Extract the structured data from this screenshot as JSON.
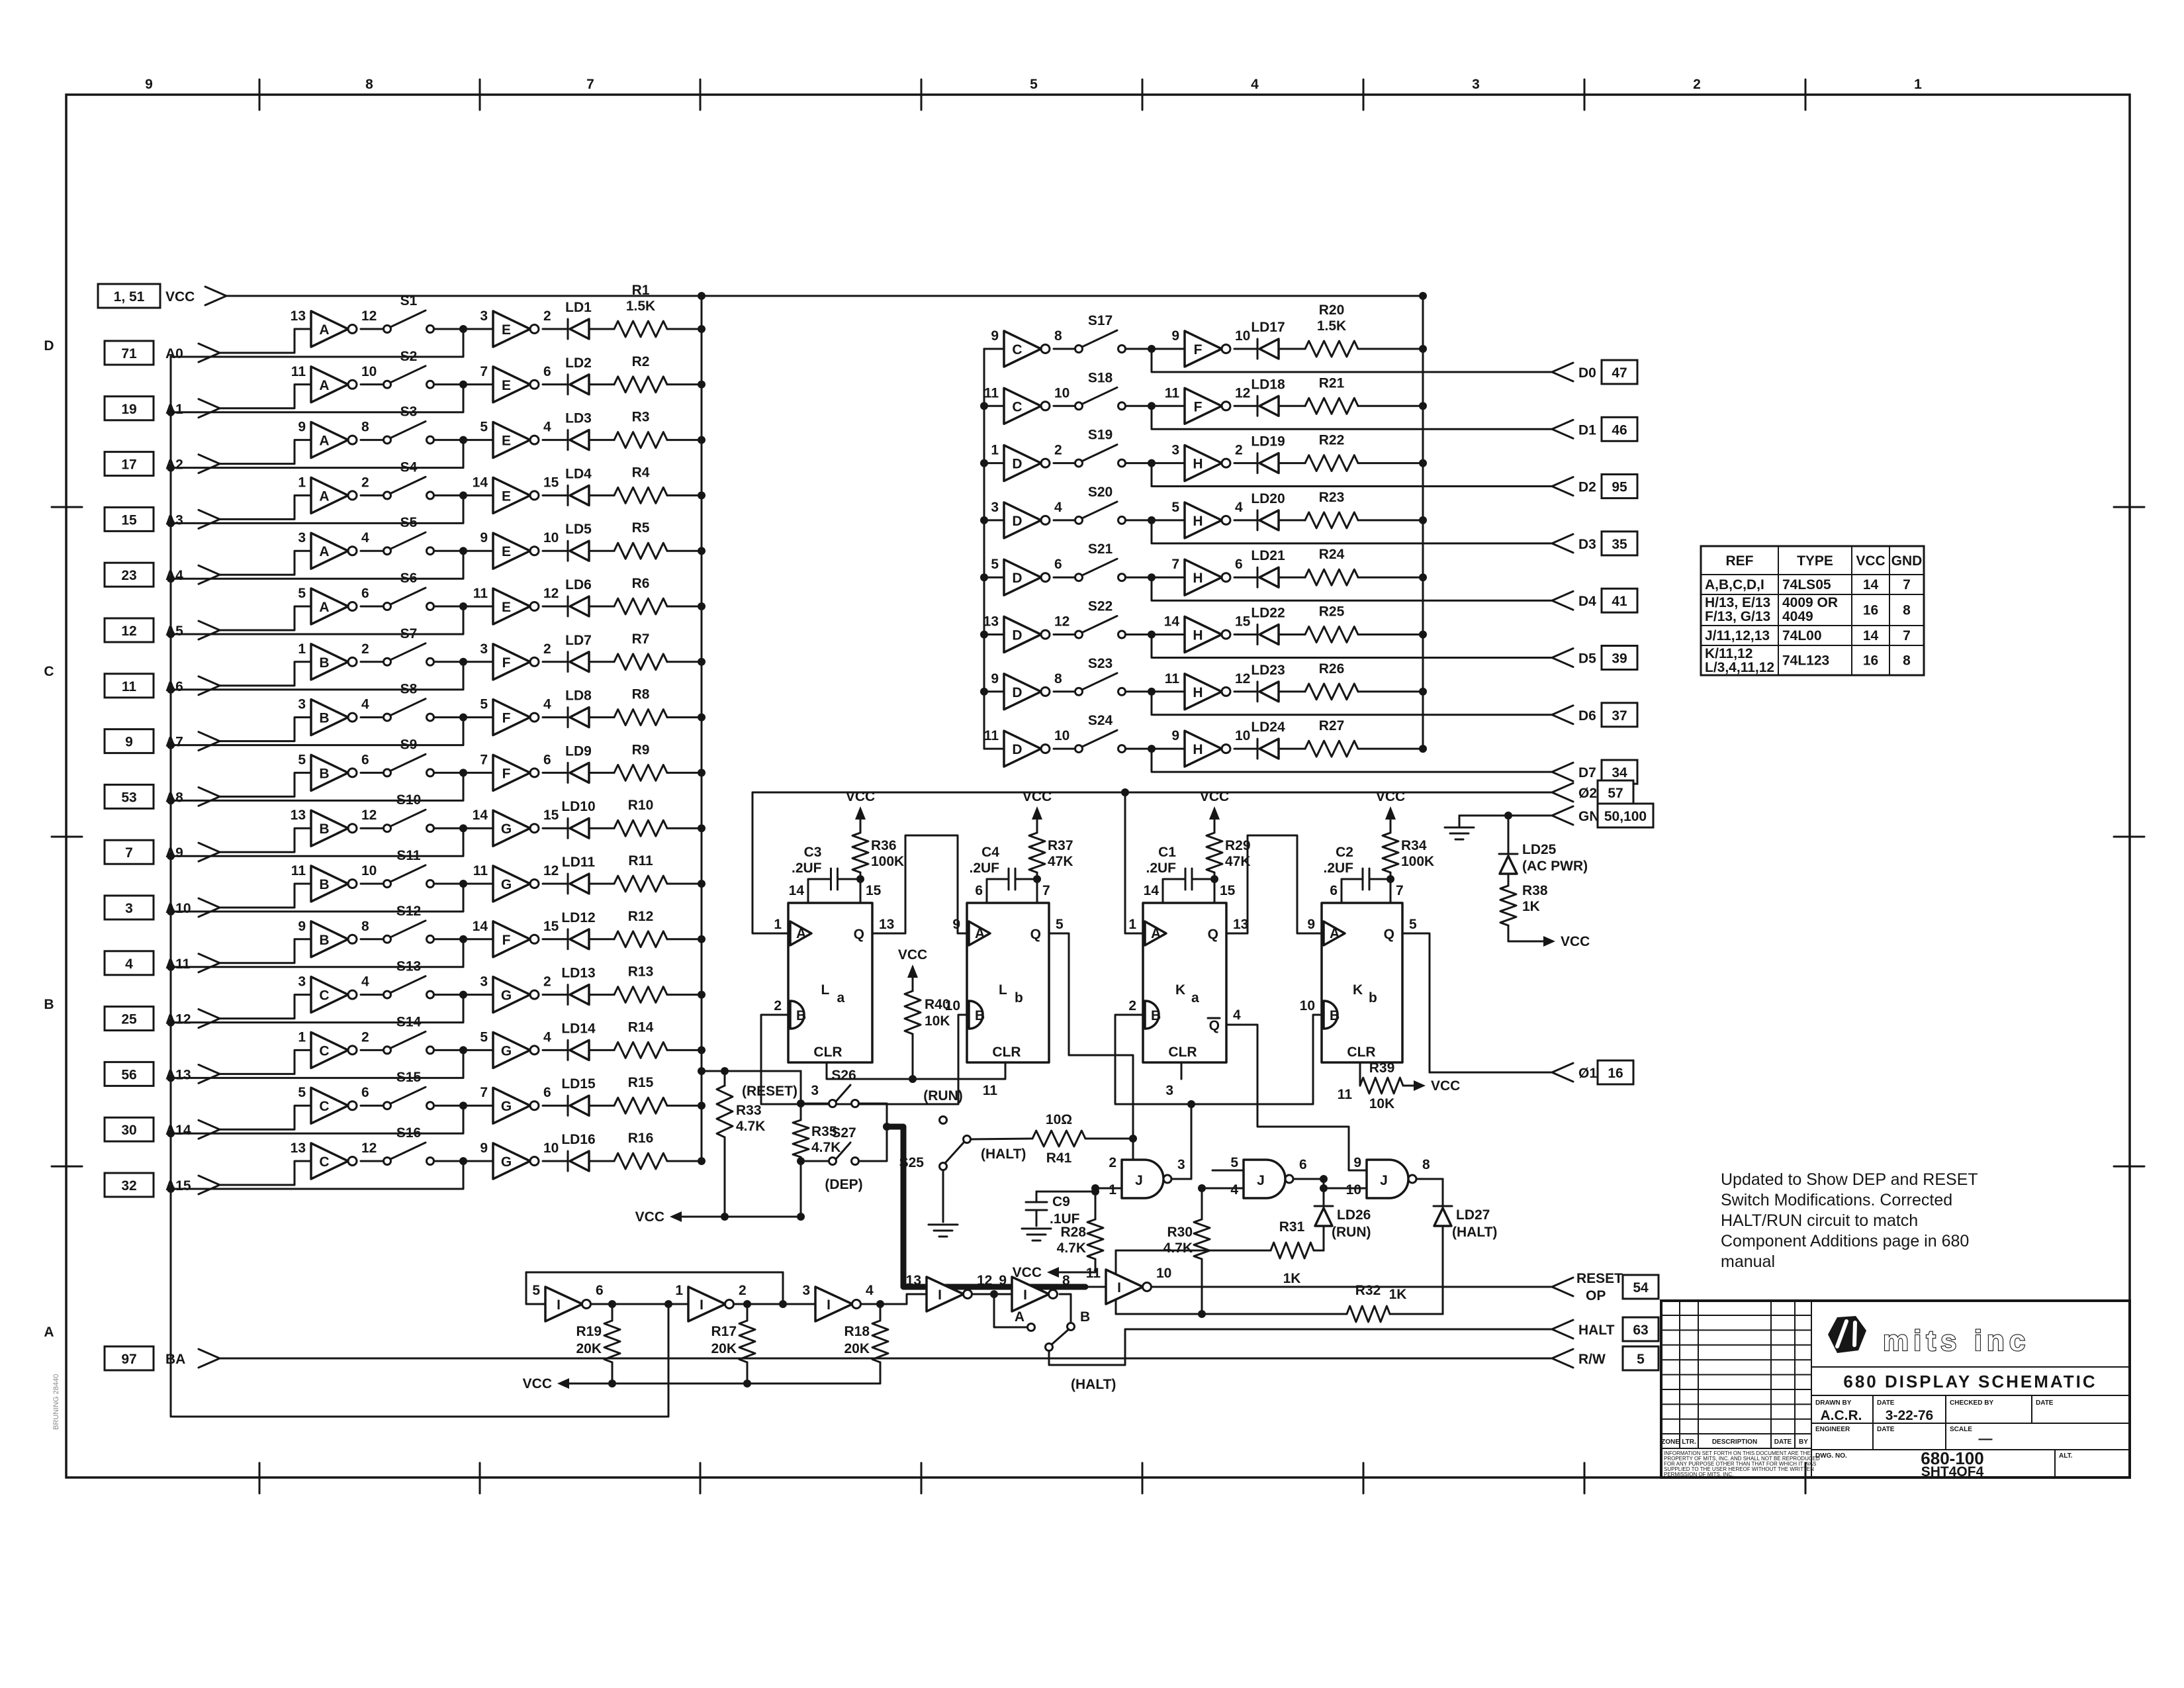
{
  "sheet": {
    "top_numbers": [
      "9",
      "8",
      "7",
      "5",
      "4",
      "3",
      "2",
      "1"
    ],
    "side_letters": [
      "D",
      "C",
      "B",
      "A"
    ],
    "stamp": "BRUNING 28440"
  },
  "left_inputs": [
    {
      "pin": "1, 51",
      "label": "VCC"
    },
    {
      "pin": "71",
      "label": "A0"
    },
    {
      "pin": "19",
      "label": "A1"
    },
    {
      "pin": "17",
      "label": "A2"
    },
    {
      "pin": "15",
      "label": "A3"
    },
    {
      "pin": "23",
      "label": "A4"
    },
    {
      "pin": "12",
      "label": "A5"
    },
    {
      "pin": "11",
      "label": "A6"
    },
    {
      "pin": "9",
      "label": "A7"
    },
    {
      "pin": "53",
      "label": "A8"
    },
    {
      "pin": "7",
      "label": "A9"
    },
    {
      "pin": "3",
      "label": "A10"
    },
    {
      "pin": "4",
      "label": "A11"
    },
    {
      "pin": "25",
      "label": "A12"
    },
    {
      "pin": "56",
      "label": "A13"
    },
    {
      "pin": "30",
      "label": "A14"
    },
    {
      "pin": "32",
      "label": "A15"
    },
    {
      "pin": "97",
      "label": "BA"
    }
  ],
  "left_rows": [
    {
      "p1": "13",
      "b1": "A",
      "p2": "12",
      "sw": "S1",
      "p3": "3",
      "b2": "E",
      "p4": "2",
      "led": "LD1",
      "res": "R1",
      "val": "1.5K"
    },
    {
      "p1": "11",
      "b1": "A",
      "p2": "10",
      "sw": "S2",
      "p3": "7",
      "b2": "E",
      "p4": "6",
      "led": "LD2",
      "res": "R2"
    },
    {
      "p1": "9",
      "b1": "A",
      "p2": "8",
      "sw": "S3",
      "p3": "5",
      "b2": "E",
      "p4": "4",
      "led": "LD3",
      "res": "R3"
    },
    {
      "p1": "1",
      "b1": "A",
      "p2": "2",
      "sw": "S4",
      "p3": "14",
      "b2": "E",
      "p4": "15",
      "led": "LD4",
      "res": "R4"
    },
    {
      "p1": "3",
      "b1": "A",
      "p2": "4",
      "sw": "S5",
      "p3": "9",
      "b2": "E",
      "p4": "10",
      "led": "LD5",
      "res": "R5"
    },
    {
      "p1": "5",
      "b1": "A",
      "p2": "6",
      "sw": "S6",
      "p3": "11",
      "b2": "E",
      "p4": "12",
      "led": "LD6",
      "res": "R6"
    },
    {
      "p1": "1",
      "b1": "B",
      "p2": "2",
      "sw": "S7",
      "p3": "3",
      "b2": "F",
      "p4": "2",
      "led": "LD7",
      "res": "R7"
    },
    {
      "p1": "3",
      "b1": "B",
      "p2": "4",
      "sw": "S8",
      "p3": "5",
      "b2": "F",
      "p4": "4",
      "led": "LD8",
      "res": "R8"
    },
    {
      "p1": "5",
      "b1": "B",
      "p2": "6",
      "sw": "S9",
      "p3": "7",
      "b2": "F",
      "p4": "6",
      "led": "LD9",
      "res": "R9"
    },
    {
      "p1": "13",
      "b1": "B",
      "p2": "12",
      "sw": "S10",
      "p3": "14",
      "b2": "G",
      "p4": "15",
      "led": "LD10",
      "res": "R10"
    },
    {
      "p1": "11",
      "b1": "B",
      "p2": "10",
      "sw": "S11",
      "p3": "11",
      "b2": "G",
      "p4": "12",
      "led": "LD11",
      "res": "R11"
    },
    {
      "p1": "9",
      "b1": "B",
      "p2": "8",
      "sw": "S12",
      "p3": "14",
      "b2": "F",
      "p4": "15",
      "led": "LD12",
      "res": "R12"
    },
    {
      "p1": "3",
      "b1": "C",
      "p2": "4",
      "sw": "S13",
      "p3": "3",
      "b2": "G",
      "p4": "2",
      "led": "LD13",
      "res": "R13"
    },
    {
      "p1": "1",
      "b1": "C",
      "p2": "2",
      "sw": "S14",
      "p3": "5",
      "b2": "G",
      "p4": "4",
      "led": "LD14",
      "res": "R14"
    },
    {
      "p1": "5",
      "b1": "C",
      "p2": "6",
      "sw": "S15",
      "p3": "7",
      "b2": "G",
      "p4": "6",
      "led": "LD15",
      "res": "R15"
    },
    {
      "p1": "13",
      "b1": "C",
      "p2": "12",
      "sw": "S16",
      "p3": "9",
      "b2": "G",
      "p4": "10",
      "led": "LD16",
      "res": "R16"
    }
  ],
  "right_rows": [
    {
      "p1": "9",
      "b1": "C",
      "p2": "8",
      "sw": "S17",
      "p3": "9",
      "b2": "F",
      "p4": "10",
      "led": "LD17",
      "res": "R20",
      "val": "1.5K",
      "out": "D0",
      "outpin": "47"
    },
    {
      "p1": "11",
      "b1": "C",
      "p2": "10",
      "sw": "S18",
      "p3": "11",
      "b2": "F",
      "p4": "12",
      "led": "LD18",
      "res": "R21",
      "out": "D1",
      "outpin": "46"
    },
    {
      "p1": "1",
      "b1": "D",
      "p2": "2",
      "sw": "S19",
      "p3": "3",
      "b2": "H",
      "p4": "2",
      "led": "LD19",
      "res": "R22",
      "out": "D2",
      "outpin": "95"
    },
    {
      "p1": "3",
      "b1": "D",
      "p2": "4",
      "sw": "S20",
      "p3": "5",
      "b2": "H",
      "p4": "4",
      "led": "LD20",
      "res": "R23",
      "out": "D3",
      "outpin": "35"
    },
    {
      "p1": "5",
      "b1": "D",
      "p2": "6",
      "sw": "S21",
      "p3": "7",
      "b2": "H",
      "p4": "6",
      "led": "LD21",
      "res": "R24",
      "out": "D4",
      "outpin": "41"
    },
    {
      "p1": "13",
      "b1": "D",
      "p2": "12",
      "sw": "S22",
      "p3": "14",
      "b2": "H",
      "p4": "15",
      "led": "LD22",
      "res": "R25",
      "out": "D5",
      "outpin": "39"
    },
    {
      "p1": "9",
      "b1": "D",
      "p2": "8",
      "sw": "S23",
      "p3": "11",
      "b2": "H",
      "p4": "12",
      "led": "LD23",
      "res": "R26",
      "out": "D6",
      "outpin": "37"
    },
    {
      "p1": "11",
      "b1": "D",
      "p2": "10",
      "sw": "S24",
      "p3": "9",
      "b2": "H",
      "p4": "10",
      "led": "LD24",
      "res": "R27",
      "out": "D7",
      "outpin": "34"
    }
  ],
  "right_outputs": {
    "phi2": {
      "label": "Ø2",
      "pin": "57"
    },
    "gnd": {
      "label": "GND",
      "pin": "50,100"
    },
    "phi1": {
      "label": "Ø1",
      "pin": "16"
    },
    "reset1": "RESET",
    "reset2": "OP",
    "resetpin": "54",
    "halt": {
      "label": "HALT",
      "pin": "63"
    },
    "rw": {
      "label": "R/W",
      "pin": "5"
    }
  },
  "oneshots": [
    {
      "name": "L",
      "sub": "a",
      "tp1": "14",
      "tp2": "15",
      "a": "1",
      "q": "13",
      "b": "2",
      "clr": "3",
      "cap": "C3",
      "capv": ".2UF",
      "res": "R36",
      "resv": "100K"
    },
    {
      "name": "L",
      "sub": "b",
      "tp1": "6",
      "tp2": "7",
      "a": "9",
      "q": "5",
      "b": "10",
      "clr": "11",
      "cap": "C4",
      "capv": ".2UF",
      "res": "R37",
      "resv": "47K"
    },
    {
      "name": "K",
      "sub": "a",
      "tp1": "14",
      "tp2": "15",
      "a": "1",
      "q": "13",
      "b": "2",
      "clr": "3",
      "qb": "4",
      "cap": "C1",
      "capv": ".2UF",
      "res": "R29",
      "resv": "47K"
    },
    {
      "name": "K",
      "sub": "b",
      "tp1": "6",
      "tp2": "7",
      "a": "9",
      "q": "5",
      "b": "10",
      "clr": "11",
      "cap": "C2",
      "capv": ".2UF",
      "res": "R34",
      "resv": "100K"
    }
  ],
  "gates": [
    {
      "pa": "2",
      "pb": "1",
      "po": "3",
      "letter": "J"
    },
    {
      "pa": "5",
      "pb": "4",
      "po": "6",
      "letter": "J"
    },
    {
      "pa": "9",
      "pb": "10",
      "po": "8",
      "letter": "J"
    }
  ],
  "bot_invs": [
    {
      "a": "5",
      "o": "6",
      "letter": "I"
    },
    {
      "a": "1",
      "o": "2",
      "letter": "I"
    },
    {
      "a": "3",
      "o": "4",
      "letter": "I"
    },
    {
      "a": "13",
      "o": "12",
      "letter": "I"
    },
    {
      "a": "9",
      "o": "8",
      "letter": "I"
    },
    {
      "a": "11",
      "o": "10",
      "letter": "I"
    }
  ],
  "labels": {
    "vcc": "VCC",
    "q": "Q",
    "aL": "A",
    "bL": "B",
    "clr": "CLR",
    "r40": "R40",
    "r40v": "10K",
    "r39": "R39",
    "r39v": "10K",
    "ld25": "LD25",
    "acpwr": "(AC PWR)",
    "r38": "R38",
    "r38v": "1K",
    "r33": "R33",
    "r33v": "4.7K",
    "r35": "R35",
    "r35v": "4.7K",
    "s26": "S26",
    "reset": "(RESET)",
    "s27": "S27",
    "dep": "(DEP)",
    "s25": "S25",
    "run": "(RUN)",
    "halt": "(HALT)",
    "r41": "R41",
    "r41v": "10Ω",
    "c9": "C9",
    "c9v": ".1UF",
    "r28": "R28",
    "r28v": "4.7K",
    "r30": "R30",
    "r30v": "4.7K",
    "r31": "R31",
    "r31v": "1K",
    "r32": "R32",
    "r32v": "1K",
    "ld26": "LD26",
    "ld27": "LD27",
    "r19": "R19",
    "r19v": "20K",
    "r17": "R17",
    "r17v": "20K",
    "r18": "R18",
    "r18v": "20K",
    "abA": "A",
    "abB": "B"
  },
  "ref_table": {
    "headers": [
      "REF",
      "TYPE",
      "VCC",
      "GND"
    ],
    "rows": [
      {
        "ref": [
          "A,B,C,D,I"
        ],
        "type": [
          "74LS05"
        ],
        "vcc": "14",
        "gnd": "7"
      },
      {
        "ref": [
          "H/13, E/13",
          "F/13, G/13"
        ],
        "type": [
          "4009  OR",
          "4049"
        ],
        "vcc": "16",
        "gnd": "8"
      },
      {
        "ref": [
          "J/11,12,13"
        ],
        "type": [
          "74L00"
        ],
        "vcc": "14",
        "gnd": "7"
      },
      {
        "ref": [
          "K/11,12",
          "L/3,4,11,12"
        ],
        "type": [
          "74L123"
        ],
        "vcc": "16",
        "gnd": "8"
      }
    ]
  },
  "note_lines": [
    "Updated to Show DEP and RESET",
    "Switch Modifications. Corrected",
    "HALT/RUN circuit to match",
    "Component Additions page in 680",
    "manual"
  ],
  "title_block": {
    "brand": "mits inc",
    "title": "680 DISPLAY SCHEMATIC",
    "drawn_by_label": "DRAWN BY",
    "drawn_by": "A.C.R.",
    "date_label": "DATE",
    "date": "3-22-76",
    "checked_label": "CHECKED BY",
    "engineer_label": "ENGINEER",
    "scale_label": "SCALE",
    "scale": "—",
    "dwg_label": "DWG. NO.",
    "dwg1": "680-100",
    "dwg2": "SHT4OF4",
    "alt_label": "ALT.",
    "zone": "ZONE",
    "ltr": "LTR.",
    "description": "DESCRIPTION",
    "by": "BY",
    "fine_print": [
      "INFORMATION SET FORTH ON THIS DOCUMENT ARE THE",
      "PROPERTY OF MITS, INC. AND SHALL NOT BE REPRODUCED",
      "FOR ANY PURPOSE OTHER THAN THAT FOR WHICH IT WAS",
      "SUPPLIED TO THE USER HEREOF WITHOUT THE WRITTEN",
      "PERMISSION OF MITS, INC."
    ]
  }
}
